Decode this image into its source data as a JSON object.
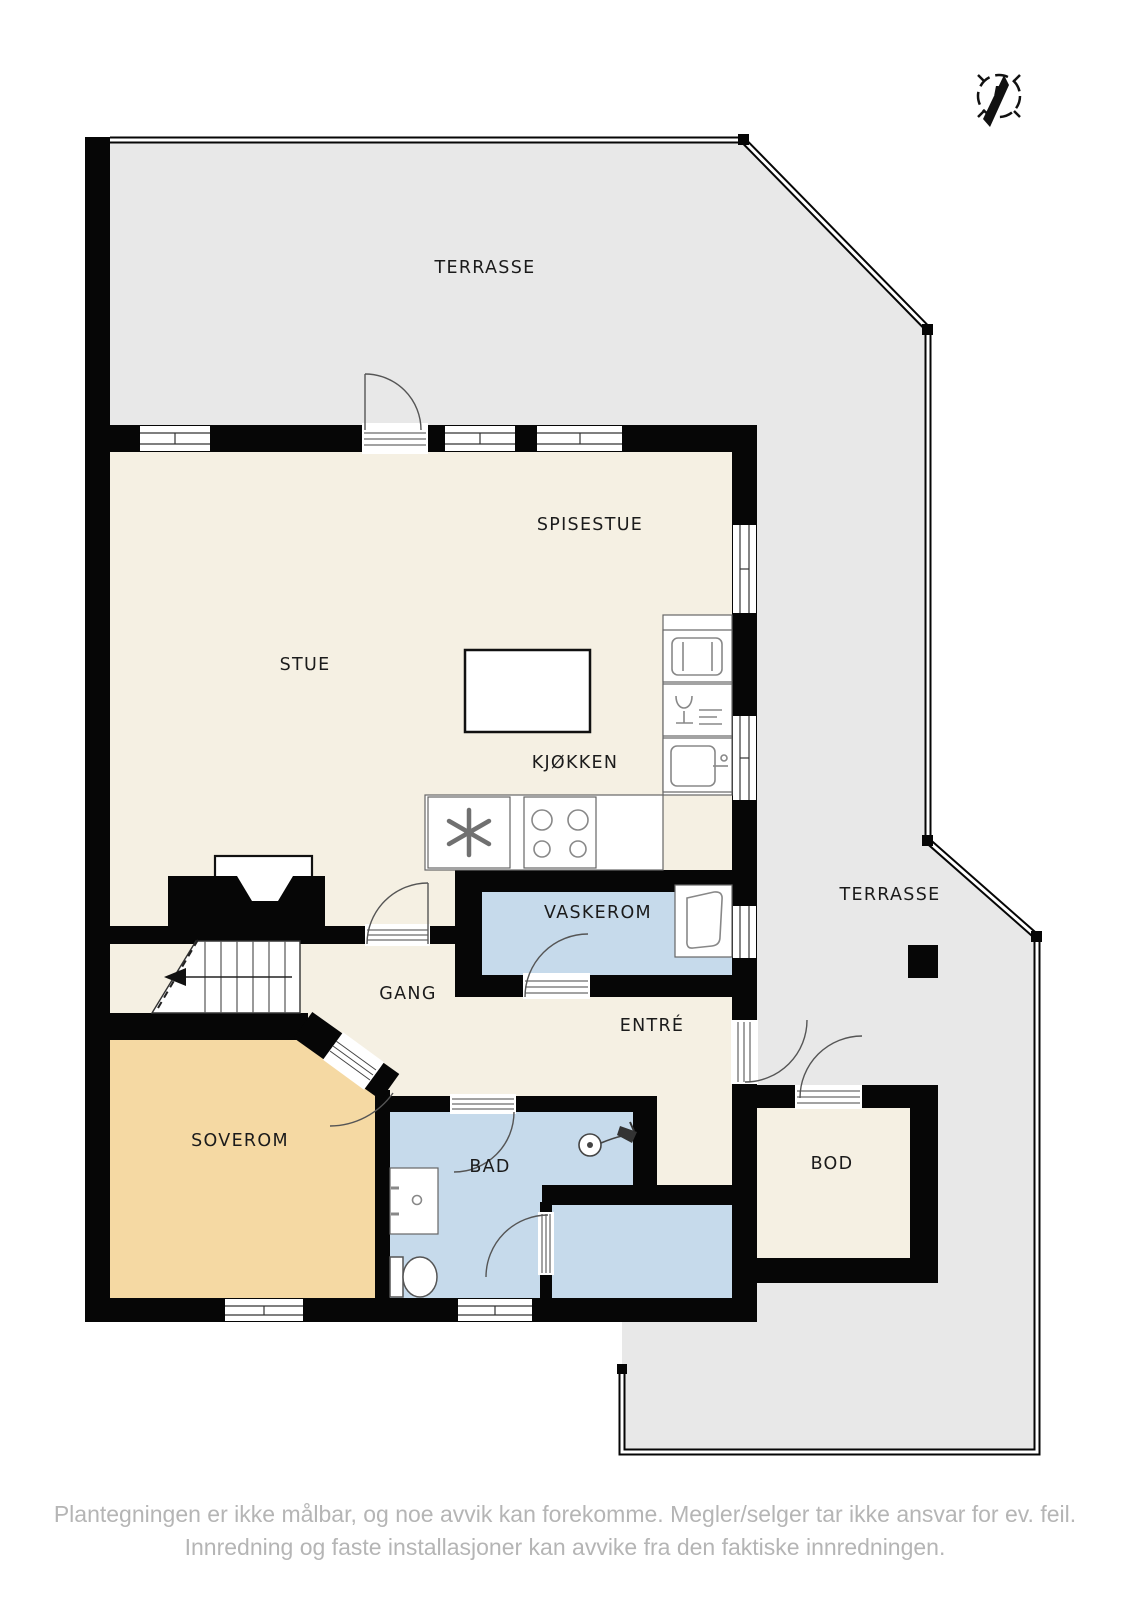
{
  "rooms": {
    "terrasse_top": "TERRASSE",
    "spisestue": "SPISESTUE",
    "stue": "STUE",
    "kjokken": "KJØKKEN",
    "vaskerom": "VASKEROM",
    "gang": "GANG",
    "entre": "ENTRÉ",
    "terrasse_right": "TERRASSE",
    "soverom": "SOVEROM",
    "bad": "BAD",
    "bod": "BOD"
  },
  "compass": {
    "north_label": "N"
  },
  "disclaimer": {
    "line1": "Plantegningen er ikke målbar, og noe avvik kan forekomme. Megler/selger tar ikke ansvar for ev. feil.",
    "line2": "Innredning og faste installasjoner kan avvike fra den faktiske innredningen."
  },
  "colors": {
    "wall": "#060606",
    "terrace": "#e8e8e8",
    "floor": "#f5f0e3",
    "bedroom": "#f5d9a3",
    "wet_room": "#c6daeb",
    "label_text": "#1b1b1b",
    "disclaimer_text": "#b5b5b5"
  }
}
